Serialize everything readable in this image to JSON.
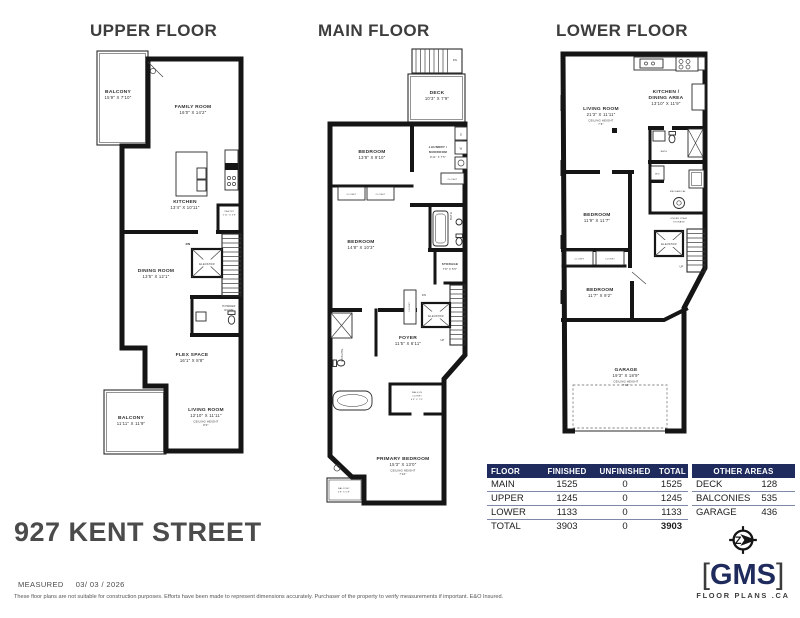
{
  "document": {
    "address": "927 KENT STREET"
  },
  "floors": {
    "upper": {
      "title": "UPPER FLOOR",
      "balcony_top": {
        "name": "BALCONY",
        "dims": "15'9\" X 7'10\""
      },
      "family_room": {
        "name": "FAMILY ROOM",
        "dims": "16'0\" X 14'2\""
      },
      "kitchen": {
        "name": "KITCHEN",
        "dims": "13'4\" X 10'11\""
      },
      "pantry": {
        "name": "PANTRY",
        "dims": "2'11\" X 3'8\""
      },
      "dining_room": {
        "name": "DINING ROOM",
        "dims": "13'5\" X 12'1\""
      },
      "elevator": "ELEVATOR",
      "stairs_dn": "DN",
      "powder_line1": "POWDER",
      "powder_line2": "ROOM",
      "flex_space": {
        "name": "FLEX SPACE",
        "dims": "16'1\" X 8'8\""
      },
      "balcony_bottom": {
        "name": "BALCONY",
        "dims": "11'11\" X 11'9\""
      },
      "living_room": {
        "name": "LIVING ROOM",
        "dims": "12'10\" X 11'11\"",
        "ch_label": "CEILING HEIGHT",
        "ch_value": "8'0\""
      }
    },
    "main": {
      "title": "MAIN FLOOR",
      "stairs_dn_top": "DN",
      "deck": {
        "name": "DECK",
        "dims": "10'3\" X 7'9\""
      },
      "bedroom_top": {
        "name": "BEDROOM",
        "dims": "13'8\" X 9'10\""
      },
      "laundry_line1": "LAUNDRY /",
      "laundry_line2": "MUDROOM",
      "laundry_dims": "9'11\" X 7'5\"",
      "closet": "CLOSET",
      "washer": "W",
      "dryer": "D",
      "bath": "BATH",
      "bedroom_mid": {
        "name": "BEDROOM",
        "dims": "14'8\" X 10'3\""
      },
      "storage": {
        "name": "STORAGE",
        "dims": "7'8\" X 5'5\""
      },
      "elevator": "ELEVATOR",
      "stairs_dn": "DN",
      "stairs_up": "UP",
      "foyer": {
        "name": "FOYER",
        "dims": "11'5\" X 6'11\""
      },
      "ensuite": "ENSUITE",
      "wic_line1": "WALK-IN",
      "wic_line2": "CLOSET",
      "wic_dims": "6'0\" X 7'6\"",
      "primary": {
        "name": "PRIMARY BEDROOM",
        "dims": "15'3\" X 13'0\"",
        "ch_label": "CEILING HEIGHT",
        "ch_value": "7'10\""
      },
      "balcony": {
        "name": "BALCONY",
        "dims": "5'8\" X 5'8\""
      }
    },
    "lower": {
      "title": "LOWER FLOOR",
      "living_room": {
        "name": "LIVING ROOM",
        "dims": "21'3\" X 11'11\"",
        "ch_label": "CEILING HEIGHT",
        "ch_value": "7'6\""
      },
      "kitchen_line1": "KITCHEN /",
      "kitchen_line2": "DINING AREA",
      "kitchen_dims": "13'10\" X 11'9\"",
      "bath": "BATH",
      "wd": "W/D",
      "mechanical": "MECHANICAL",
      "uss_line1": "UNDER STAIR",
      "uss_line2": "STORAGE",
      "elevator": "ELEVATOR",
      "stairs_up": "UP",
      "closet": "CLOSET",
      "bedroom_upper": {
        "name": "BEDROOM",
        "dims": "11'9\" X 11'7\""
      },
      "bedroom_lower": {
        "name": "BEDROOM",
        "dims": "11'7\" X 9'2\""
      },
      "garage": {
        "name": "GARAGE",
        "dims": "19'3\" X 18'9\"",
        "ch_label": "CEILING HEIGHT",
        "ch_value": "7'10\""
      }
    }
  },
  "area_table": {
    "headers": [
      "FLOOR",
      "FINISHED",
      "UNFINISHED",
      "TOTAL"
    ],
    "rows": [
      [
        "MAIN",
        "1525",
        "0",
        "1525"
      ],
      [
        "UPPER",
        "1245",
        "0",
        "1245"
      ],
      [
        "LOWER",
        "1133",
        "0",
        "1133"
      ],
      [
        "TOTAL",
        "3903",
        "0",
        "3903"
      ]
    ]
  },
  "other_areas": {
    "title": "OTHER AREAS",
    "rows": [
      [
        "DECK",
        "128"
      ],
      [
        "BALCONIES",
        "535"
      ],
      [
        "GARAGE",
        "436"
      ]
    ]
  },
  "footer": {
    "measured_label": "MEASURED",
    "measured_date": "03/ 03 / 2026",
    "disclaimer": "These floor plans are not suitable for construction purposes. Efforts have been made to represent dimensions accurately.  Purchaser of the property to verify measurements if important.  E&O Insured."
  },
  "logo": {
    "bracket_l": "[",
    "brand": "GMS",
    "bracket_r": "]",
    "tagline": "FLOOR PLANS .CA",
    "compass_letter": "Z"
  },
  "colors": {
    "navy": "#1e2b5c",
    "wall": "#151515"
  }
}
